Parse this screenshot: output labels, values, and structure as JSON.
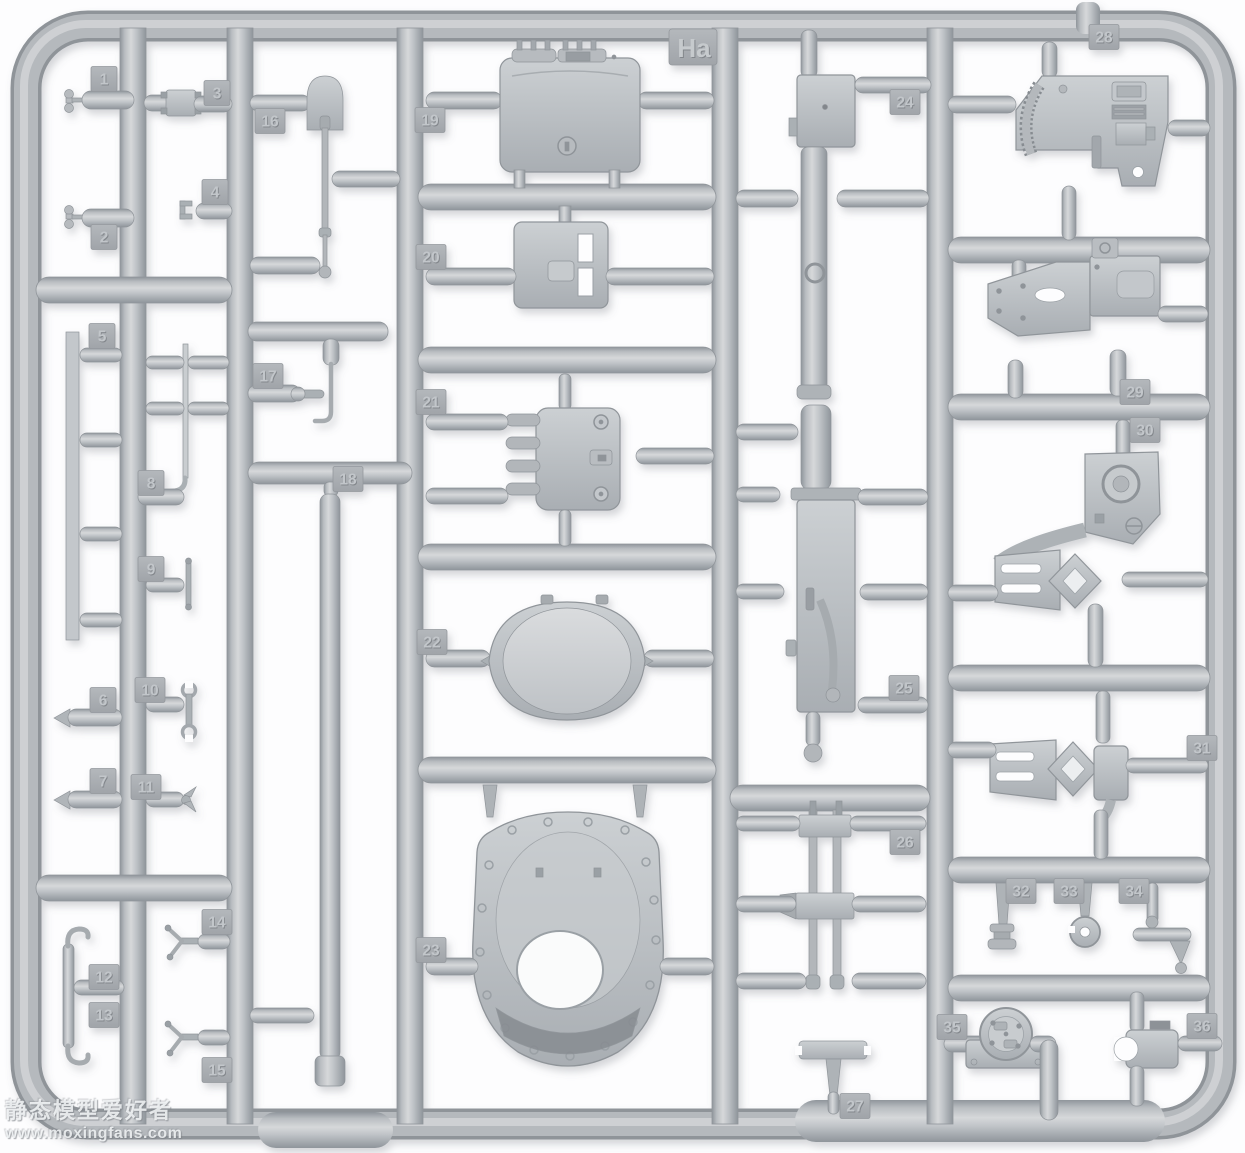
{
  "photo": {
    "subject": "injection-molded plastic model kit sprue with numbered parts",
    "background": "#ffffff"
  },
  "colors": {
    "plastic_mid": "#b9bdc1",
    "plastic_light": "#d6d8da",
    "plastic_dark": "#8f959b",
    "tag_face": "#aaaeb3"
  },
  "sprue": {
    "code": "Ha",
    "part_count": 36
  },
  "watermark": {
    "line1": "静态模型爱好者",
    "line2": "www.moxingfans.com"
  },
  "parts": [
    {
      "number": "1",
      "name": "wing-handle-pin",
      "tag_x": 104,
      "tag_y": 79
    },
    {
      "number": "2",
      "name": "wing-handle-pin",
      "tag_x": 104,
      "tag_y": 237
    },
    {
      "number": "3",
      "name": "hinge-bracket",
      "tag_x": 217,
      "tag_y": 93
    },
    {
      "number": "4",
      "name": "hook-clamp",
      "tag_x": 215,
      "tag_y": 192
    },
    {
      "number": "5",
      "name": "flat-strip-rail",
      "tag_x": 102,
      "tag_y": 336
    },
    {
      "number": "6",
      "name": "tapered-peg",
      "tag_x": 103,
      "tag_y": 700
    },
    {
      "number": "7",
      "name": "tapered-peg",
      "tag_x": 103,
      "tag_y": 781
    },
    {
      "number": "8",
      "name": "long-rod-with-elbow",
      "tag_x": 151,
      "tag_y": 483
    },
    {
      "number": "9",
      "name": "t-handle-rod",
      "tag_x": 151,
      "tag_y": 569
    },
    {
      "number": "10",
      "name": "open-end-wrench",
      "tag_x": 150,
      "tag_y": 690
    },
    {
      "number": "11",
      "name": "small-winged-fitting",
      "tag_x": 146,
      "tag_y": 787
    },
    {
      "number": "12",
      "name": "hook-bar-end",
      "tag_x": 104,
      "tag_y": 977
    },
    {
      "number": "13",
      "name": "hook-bar-end",
      "tag_x": 104,
      "tag_y": 1015
    },
    {
      "number": "14",
      "name": "pronged-bracket",
      "tag_x": 217,
      "tag_y": 922
    },
    {
      "number": "15",
      "name": "pronged-bracket",
      "tag_x": 217,
      "tag_y": 1070
    },
    {
      "number": "16",
      "name": "shovel",
      "tag_x": 270,
      "tag_y": 121
    },
    {
      "number": "17",
      "name": "crank-handle",
      "tag_x": 268,
      "tag_y": 376
    },
    {
      "number": "18",
      "name": "barrel-tube",
      "tag_x": 348,
      "tag_y": 479
    },
    {
      "number": "19",
      "name": "hatch-lid-box",
      "tag_x": 430,
      "tag_y": 120
    },
    {
      "number": "20",
      "name": "hatch-plate",
      "tag_x": 431,
      "tag_y": 257
    },
    {
      "number": "21",
      "name": "hinged-hatch",
      "tag_x": 431,
      "tag_y": 402
    },
    {
      "number": "22",
      "name": "dome-hatch-cover",
      "tag_x": 432,
      "tag_y": 642
    },
    {
      "number": "23",
      "name": "mantlet-housing",
      "tag_x": 431,
      "tag_y": 950
    },
    {
      "number": "24",
      "name": "machine-gun-upper",
      "tag_x": 905,
      "tag_y": 102
    },
    {
      "number": "25",
      "name": "machine-gun-receiver",
      "tag_x": 904,
      "tag_y": 688
    },
    {
      "number": "26",
      "name": "twin-rod-assembly",
      "tag_x": 905,
      "tag_y": 842
    },
    {
      "number": "27",
      "name": "flat-bar-with-stem",
      "tag_x": 855,
      "tag_y": 1106
    },
    {
      "number": "28",
      "name": "mount-plate-with-rack",
      "tag_x": 1104,
      "tag_y": 37
    },
    {
      "number": "29",
      "name": "bracket-arm",
      "tag_x": 1135,
      "tag_y": 392
    },
    {
      "number": "30",
      "name": "curved-fork-bracket",
      "tag_x": 1145,
      "tag_y": 430
    },
    {
      "number": "31",
      "name": "curved-fork-bracket",
      "tag_x": 1202,
      "tag_y": 748
    },
    {
      "number": "32",
      "name": "flanged-stem",
      "tag_x": 1021,
      "tag_y": 891
    },
    {
      "number": "33",
      "name": "wheel-stem",
      "tag_x": 1069,
      "tag_y": 891
    },
    {
      "number": "34",
      "name": "rod-with-cone-foot",
      "tag_x": 1134,
      "tag_y": 891
    },
    {
      "number": "35",
      "name": "round-flange-mount",
      "tag_x": 952,
      "tag_y": 1027
    },
    {
      "number": "36",
      "name": "u-clamp-block",
      "tag_x": 1202,
      "tag_y": 1026
    }
  ]
}
